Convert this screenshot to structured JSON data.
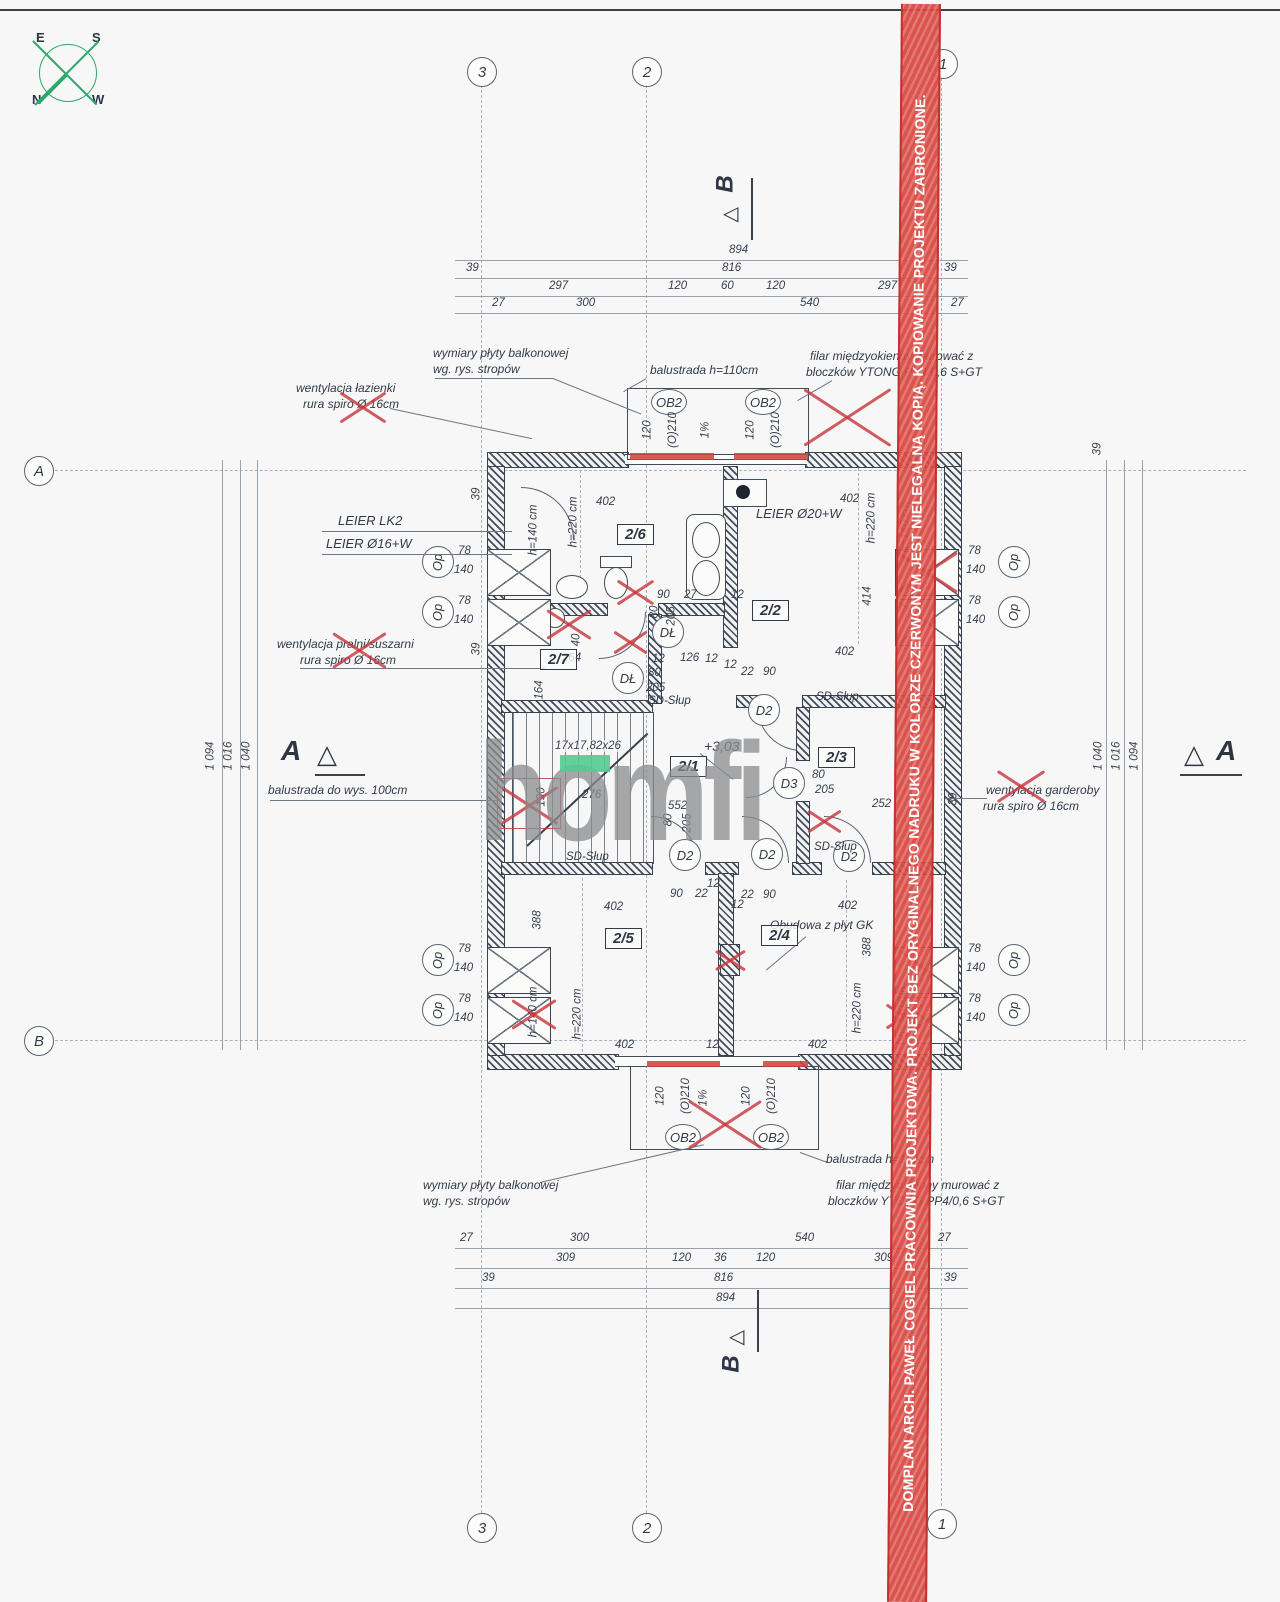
{
  "watermark": {
    "text": "DOMPLAN ARCH. PAWEŁ COGIEL PRACOWNIA PROJEKTOWA. PROJEKT BEZ ORYGINALNEGO NADRUKU W KOLORZE CZERWONYM JEST NIELEGALNĄ KOPIĄ. KOPIOWANIE PROJEKTU ZABRONIONE.",
    "color": "#d8464 0"
  },
  "logo": {
    "text": "homfi"
  },
  "compass": {
    "e": "E",
    "s": "S",
    "n": "N",
    "w": "W"
  },
  "grid": {
    "g1": "1",
    "g2": "2",
    "g3": "3",
    "ga": "A",
    "gb": "B"
  },
  "marks": {
    "a": "A",
    "b": "B",
    "tri_up": "△",
    "tri_left": "◁"
  },
  "rooms": {
    "r21": "2/1",
    "r22": "2/2",
    "r23": "2/3",
    "r24": "2/4",
    "r25": "2/5",
    "r26": "2/6",
    "r27": "2/7"
  },
  "doors": {
    "dl": "DŁ",
    "d2": "D2",
    "d3": "D3"
  },
  "openings": {
    "ob2": "OB2",
    "op": "Op",
    "w78": "78",
    "w140": "140",
    "b120": "120",
    "b210": "(O)210",
    "slope": "1%"
  },
  "dims": {
    "v894": "894",
    "v816": "816",
    "v39": "39",
    "v297": "297",
    "v120": "120",
    "v60": "60",
    "v540": "540",
    "v27": "27",
    "v300": "300",
    "v309": "309",
    "v36": "36",
    "v402": "402",
    "v388": "388",
    "v414": "414",
    "v552": "552",
    "v276": "276",
    "v264": "264",
    "v164": "164",
    "v126": "126",
    "v190": "190",
    "v252": "252",
    "v205": "205",
    "v80": "80",
    "v90": "90",
    "v22": "22",
    "v12": "12",
    "v40": "40",
    "h220": "h=220 cm",
    "h140": "h=140 cm",
    "l1094": "1 094",
    "l1016": "1 016",
    "l1040": "1 040",
    "stairs": "17x17,82x26",
    "level": "+3,03"
  },
  "annotations": {
    "balcony_plate_1": "wymiary płyty balkonowej",
    "balcony_plate_2": "wg. rys. stropów",
    "balustrade_110": "balustrada h=110cm",
    "vent_bath": "wentylacja łazienki",
    "rura_spiro": "rura spiro Ø 16cm",
    "filar_1": "filar międzyokienny murować z",
    "filar_2": "bloczków YTONG PP4/0,6 S+GT",
    "leier_lk2": "LEIER LK2",
    "leier_o16": "LEIER Ø16+W",
    "leier_o20": "LEIER Ø20+W",
    "vent_laundry": "wentylacja pralni/suszarni",
    "balustrade_100": "balustrada do wys. 100cm",
    "vent_wardrobe": "wentylacja garderoby",
    "gk": "Obudowa z płyt GK",
    "sd_slup": "SD-Słup"
  }
}
